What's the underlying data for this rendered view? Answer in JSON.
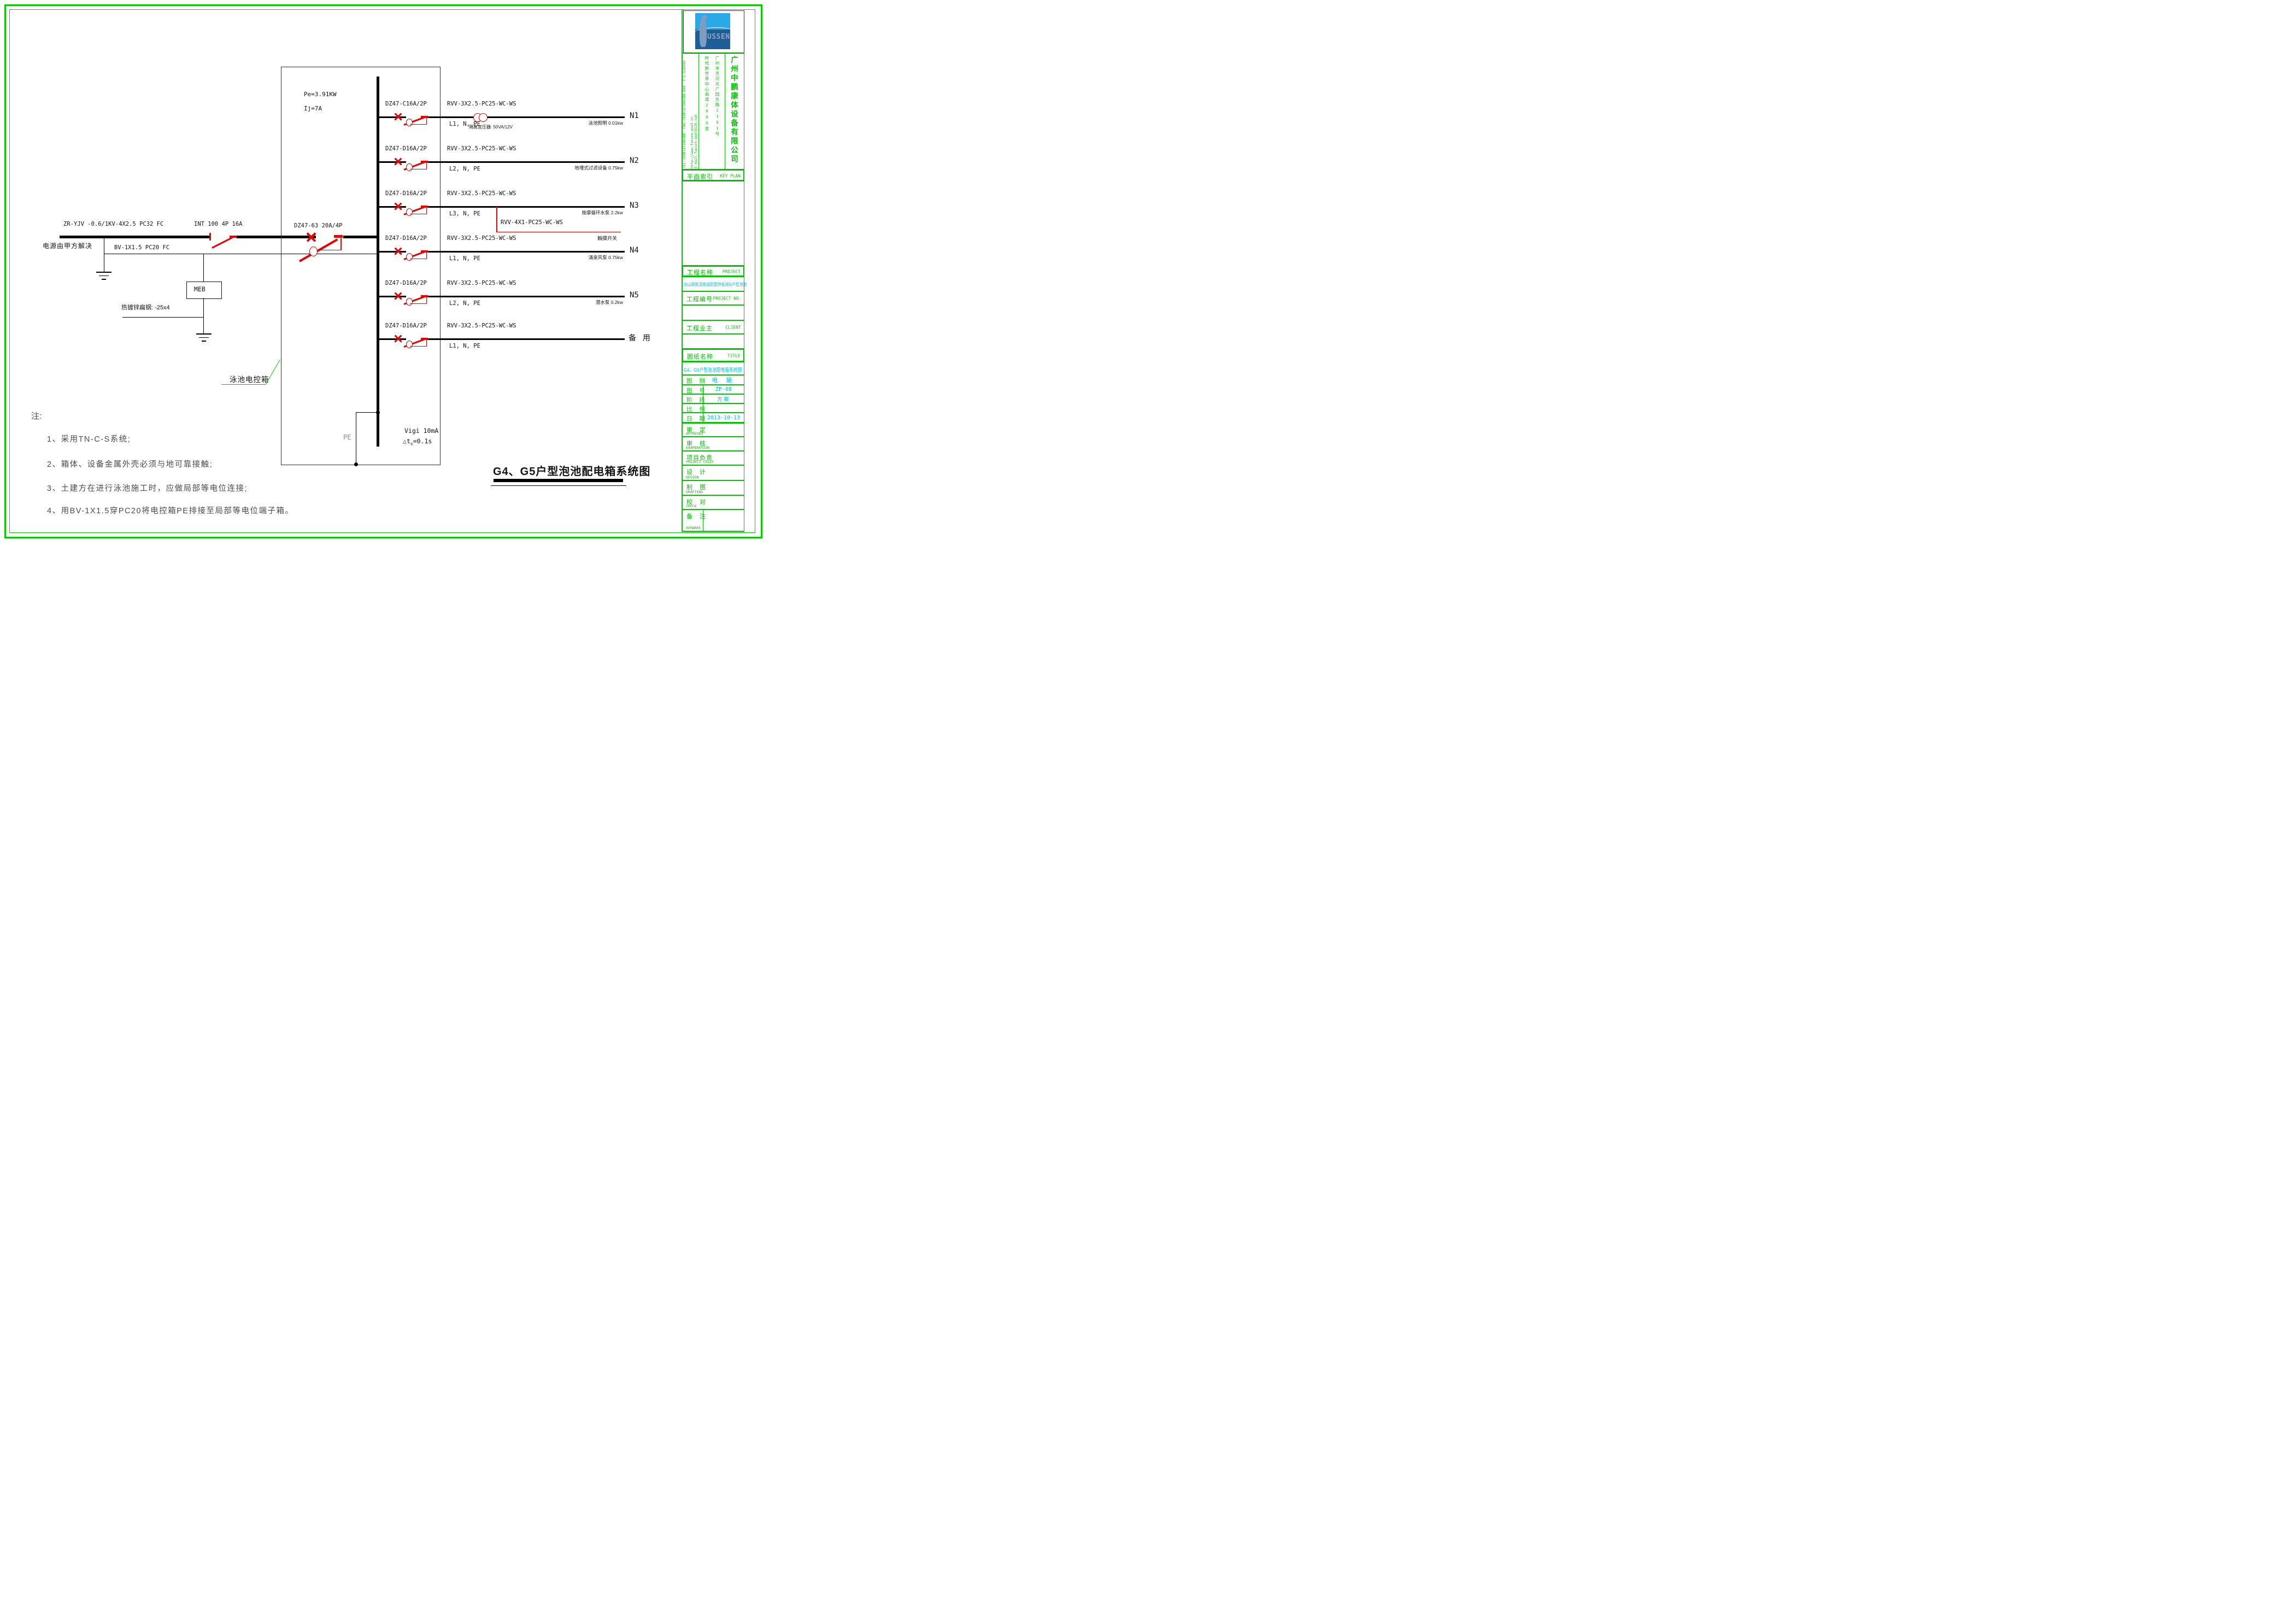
{
  "source": {
    "supply_note": "电源由甲方解决",
    "feeder_cable": "ZR-YJV -0.6/1KV-4X2.5 PC32  FC",
    "isolator": "INT 100 4P 16A",
    "pe_cable": "BV-1X1.5 PC20 FC",
    "meb": "MEB",
    "flat_steel": "热镀锌扁钢: -25x4",
    "main_breaker": "DZ47-63 20A/4P",
    "panel_power": "Pe=3.91KW",
    "panel_current": "Ij=7A",
    "panel_label": "泳池电控箱",
    "pe_bar": "PE",
    "vigi": "Vigi  10mA",
    "vigi_delta": "△",
    "vigi_t": "t",
    "vigi_sub": "s",
    "vigi_rest": "=0.1s"
  },
  "branches": [
    {
      "id": "N1",
      "breaker": "DZ47-C16A/2P",
      "cable": "RVV-3X2.5-PC25-WC-WS",
      "phases": "L1, N, PE",
      "load": "泳池照明 0.01kw",
      "transformer_label": "隔离变压器: 50VA/12V"
    },
    {
      "id": "N2",
      "breaker": "DZ47-D16A/2P",
      "cable": "RVV-3X2.5-PC25-WC-WS",
      "phases": "L2, N, PE",
      "load": "地埋式过滤设备 0.75kw"
    },
    {
      "id": "N3",
      "breaker": "DZ47-D16A/2P",
      "cable": "RVV-3X2.5-PC25-WC-WS",
      "phases": "L3, N, PE",
      "load": "按摩循环水泵 2.2kw",
      "tap_cable": "RVV-4X1-PC25-WC-WS",
      "tap_load": "触摸开关"
    },
    {
      "id": "N4",
      "breaker": "DZ47-D16A/2P",
      "cable": "RVV-3X2.5-PC25-WC-WS",
      "phases": "L1, N, PE",
      "load": "涌泉风泵 0.75kw"
    },
    {
      "id": "N5",
      "breaker": "DZ47-D16A/2P",
      "cable": "RVV-3X2.5-PC25-WC-WS",
      "phases": "L2, N, PE",
      "load": "潜水泵 0.2kw"
    },
    {
      "id": "备 用",
      "breaker": "DZ47-D16A/2P",
      "cable": "RVV-3X2.5-PC25-WC-WS",
      "phases": "L1, N, PE",
      "load": ""
    }
  ],
  "notes": {
    "head": "注:",
    "item1": "1、采用TN-C-S系统;",
    "item2": "2、箱体、设备金属外壳必须与地可靠接触;",
    "item3": "3、土建方在进行泳池施工时，应做局部等电位连接;",
    "item4": "4、用BV-1X1.5穿PC20将电控箱PE排接至局部等电位端子箱。"
  },
  "diagram_title": "G4、G5户型泡池配电箱系统图",
  "titleblock": {
    "logo_text": "USSEN",
    "company": "广州中鹏康体设备有限公司",
    "address1": "广州市天河北广园东路2191号",
    "address2": "时代新世界中心南塔2885室",
    "web": "Http://www.fussen-pool.cn",
    "email": "E-mail:fussen-pool@126.com",
    "tel": "TEL:(020)87244208",
    "fax": "FAX:(020)87244208-608",
    "postcode": "P.C:510500",
    "keyplan_zh": "平面索引",
    "keyplan_en": "KEY PLAN",
    "project_zh": "工程名称",
    "project_en": "PROJECT",
    "project_value": "台山颐和温泉城别墅样板房G户型泡池",
    "projectno_zh": "工程编号",
    "projectno_en": "PROJECT NO.",
    "projectno_value": "",
    "client_zh": "工程业主",
    "client_en": "CLIENT",
    "client_value": "",
    "sheet_zh": "图纸名称",
    "sheet_en": "TITLE",
    "sheet_value": "G4、G5户型泡池配电箱系统图",
    "category_label": "图 别",
    "category_value": "电 施",
    "number_label": "图 号",
    "number_value": "ZP-08",
    "stage_label": "阶 段",
    "stage_value": "方案",
    "scale_label": "比 例",
    "scale_value": "",
    "date_label": "日 期",
    "date_value": "2013-10-13",
    "approved_zh": "审 定",
    "approved_en": "APPROVED",
    "exam_zh": "审 核",
    "exam_en": "EXAMINATION",
    "chief_zh": "项目负责",
    "chief_en": "PROJECT CHIEF",
    "design_zh": "设 计",
    "design_en": "DESIGN",
    "draft_zh": "制 图",
    "draft_en": "DRAFTING",
    "check_zh": "校 对",
    "check_en": "CHECK",
    "remark_zh": "备 注",
    "remark_en": "REMARKS"
  }
}
